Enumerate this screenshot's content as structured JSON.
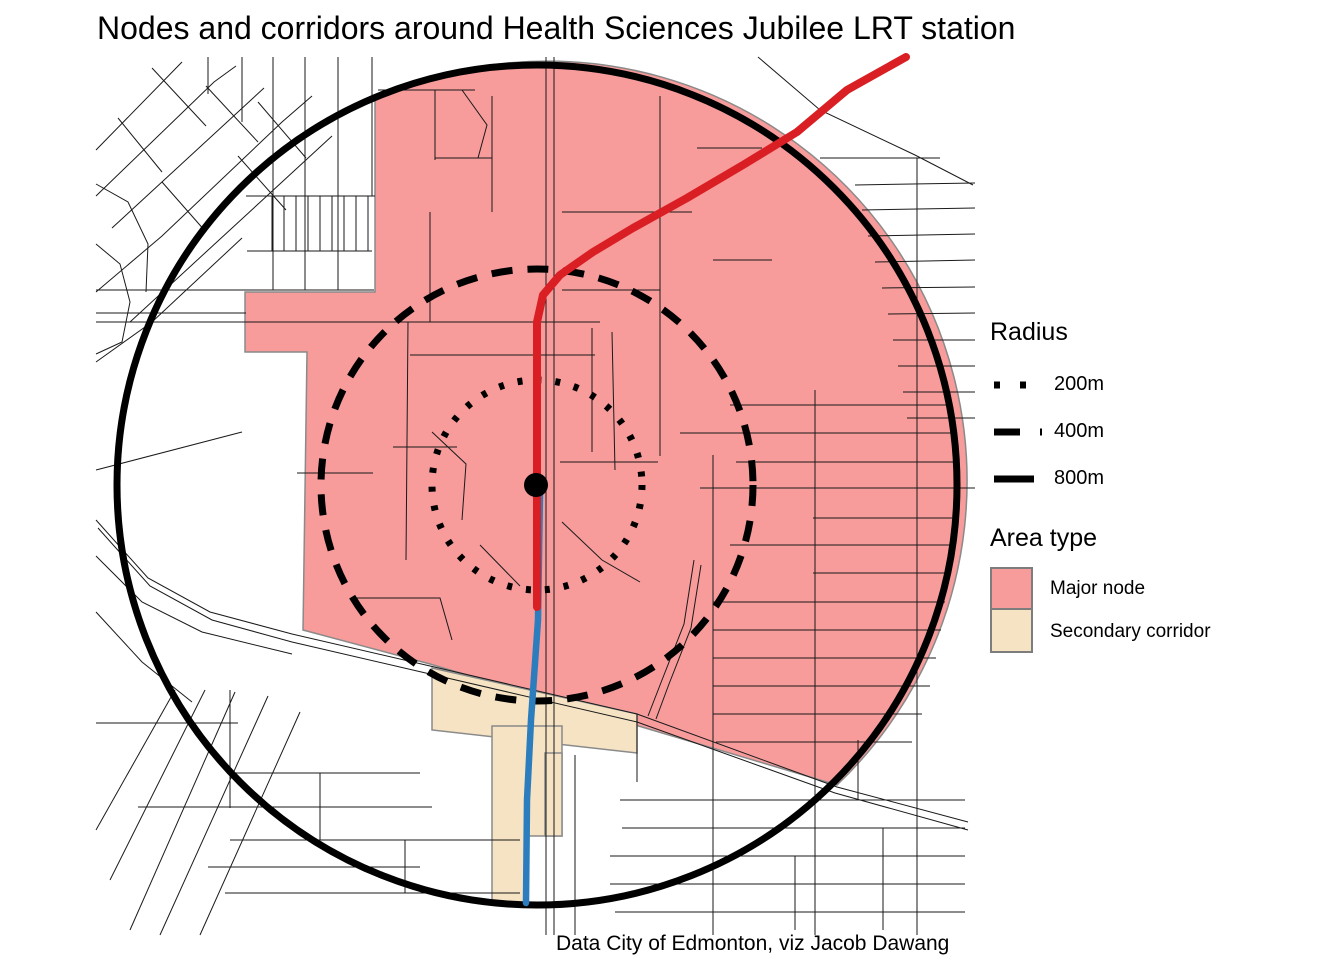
{
  "title": "Nodes and corridors around Health Sciences Jubilee LRT station",
  "caption": "Data City of Edmonton, viz Jacob Dawang",
  "legend": {
    "radius": {
      "title": "Radius",
      "items": [
        {
          "label": "200m",
          "style": "dotted"
        },
        {
          "label": "400m",
          "style": "dashed"
        },
        {
          "label": "800m",
          "style": "solid"
        }
      ]
    },
    "area_type": {
      "title": "Area type",
      "items": [
        {
          "label": "Major node",
          "color_key": "major_node"
        },
        {
          "label": "Secondary corridor",
          "color_key": "secondary_corridor"
        }
      ]
    }
  },
  "colors": {
    "major_node": "#F79B9B",
    "secondary_corridor": "#F5E3C3",
    "area_outline": "#8A8A8A",
    "lrt_line_northeast": "#D91F24",
    "lrt_line_south": "#2B7DBD",
    "street": "#1A1A1A",
    "ring": "#000000",
    "station": "#000000"
  },
  "map": {
    "center": {
      "x": 537,
      "y": 485
    },
    "station_point": {
      "x": 536,
      "y": 485,
      "radius_px": 12
    },
    "rings": [
      {
        "label": "200m",
        "meters": 200,
        "r_px": 105,
        "style": "dotted"
      },
      {
        "label": "400m",
        "meters": 400,
        "r_px": 216,
        "style": "dashed"
      },
      {
        "label": "800m",
        "meters": 800,
        "r_px": 420,
        "style": "solid"
      }
    ],
    "major_node_path": "M375 98 A420 420 0 0 1 837 785 L430 664 L303 630 L307 352 L245 352 L245 292 L375 292 Z",
    "secondary_polygons": [
      [
        [
          432,
          668
        ],
        [
          637,
          714
        ],
        [
          637,
          753
        ],
        [
          432,
          730
        ]
      ],
      [
        [
          492,
          726
        ],
        [
          562,
          726
        ],
        [
          562,
          836
        ],
        [
          528,
          836
        ],
        [
          528,
          903
        ],
        [
          492,
          903
        ]
      ],
      [
        [
          545,
          753
        ],
        [
          562,
          753
        ],
        [
          562,
          836
        ],
        [
          545,
          836
        ]
      ]
    ],
    "lrt_red": [
      [
        906,
        57
      ],
      [
        847,
        90
      ],
      [
        797,
        132
      ],
      [
        743,
        165
      ],
      [
        687,
        198
      ],
      [
        633,
        228
      ],
      [
        593,
        252
      ],
      [
        560,
        275
      ],
      [
        543,
        295
      ],
      [
        537,
        322
      ],
      [
        537,
        607
      ]
    ],
    "lrt_blue": [
      [
        540,
        492
      ],
      [
        538,
        620
      ],
      [
        531,
        720
      ],
      [
        527,
        800
      ],
      [
        526,
        903
      ]
    ],
    "streets": [
      [
        [
          96,
          520
        ],
        [
          148,
          578
        ],
        [
          210,
          612
        ],
        [
          292,
          634
        ],
        [
          430,
          666
        ],
        [
          637,
          714
        ],
        [
          837,
          787
        ],
        [
          968,
          822
        ]
      ],
      [
        [
          98,
          528
        ],
        [
          150,
          586
        ],
        [
          212,
          620
        ],
        [
          292,
          642
        ],
        [
          430,
          674
        ],
        [
          637,
          722
        ],
        [
          835,
          793
        ],
        [
          968,
          830
        ]
      ],
      [
        [
          546,
          57
        ],
        [
          546,
          935
        ]
      ],
      [
        [
          554,
          57
        ],
        [
          554,
          935
        ]
      ],
      [
        [
          96,
          150
        ],
        [
          182,
          62
        ]
      ],
      [
        [
          96,
          196
        ],
        [
          214,
          82
        ],
        [
          236,
          66
        ]
      ],
      [
        [
          112,
          228
        ],
        [
          264,
          88
        ]
      ],
      [
        [
          96,
          292
        ],
        [
          162,
          236
        ],
        [
          282,
          122
        ],
        [
          312,
          96
        ]
      ],
      [
        [
          130,
          322
        ],
        [
          206,
          252
        ],
        [
          332,
          136
        ]
      ],
      [
        [
          96,
          362
        ],
        [
          152,
          322
        ],
        [
          242,
          238
        ]
      ],
      [
        [
          152,
          68
        ],
        [
          206,
          126
        ]
      ],
      [
        [
          206,
          86
        ],
        [
          258,
          142
        ]
      ],
      [
        [
          258,
          102
        ],
        [
          306,
          158
        ]
      ],
      [
        [
          162,
          182
        ],
        [
          206,
          232
        ]
      ],
      [
        [
          238,
          156
        ],
        [
          286,
          210
        ]
      ],
      [
        [
          118,
          118
        ],
        [
          162,
          172
        ]
      ],
      [
        [
          96,
          184
        ],
        [
          128,
          202
        ],
        [
          148,
          244
        ],
        [
          146,
          292
        ]
      ],
      [
        [
          96,
          244
        ],
        [
          120,
          264
        ],
        [
          130,
          302
        ],
        [
          122,
          342
        ],
        [
          96,
          354
        ]
      ],
      [
        [
          208,
          57
        ],
        [
          208,
          94
        ]
      ],
      [
        [
          242,
          57
        ],
        [
          242,
          122
        ]
      ],
      [
        [
          273,
          57
        ],
        [
          273,
          290
        ]
      ],
      [
        [
          305,
          57
        ],
        [
          305,
          290
        ]
      ],
      [
        [
          338,
          57
        ],
        [
          338,
          290
        ]
      ],
      [
        [
          372,
          57
        ],
        [
          372,
          196
        ]
      ],
      [
        [
          246,
          196
        ],
        [
          375,
          196
        ]
      ],
      [
        [
          272,
          196
        ],
        [
          272,
          251
        ]
      ],
      [
        [
          284,
          196
        ],
        [
          284,
          251
        ]
      ],
      [
        [
          296,
          196
        ],
        [
          296,
          251
        ]
      ],
      [
        [
          308,
          196
        ],
        [
          308,
          251
        ]
      ],
      [
        [
          320,
          196
        ],
        [
          320,
          251
        ]
      ],
      [
        [
          332,
          196
        ],
        [
          332,
          251
        ]
      ],
      [
        [
          344,
          196
        ],
        [
          344,
          251
        ]
      ],
      [
        [
          356,
          196
        ],
        [
          356,
          251
        ]
      ],
      [
        [
          368,
          196
        ],
        [
          368,
          251
        ]
      ],
      [
        [
          247,
          251
        ],
        [
          372,
          251
        ]
      ],
      [
        [
          96,
          290
        ],
        [
          374,
          290
        ]
      ],
      [
        [
          96,
          313
        ],
        [
          246,
          313
        ]
      ],
      [
        [
          96,
          322
        ],
        [
          600,
          322
        ]
      ],
      [
        [
          96,
          470
        ],
        [
          242,
          432
        ]
      ],
      [
        [
          96,
          556
        ],
        [
          142,
          602
        ],
        [
          202,
          632
        ],
        [
          292,
          654
        ]
      ],
      [
        [
          96,
          612
        ],
        [
          142,
          662
        ],
        [
          192,
          702
        ]
      ],
      [
        [
          175,
          690
        ],
        [
          96,
          830
        ]
      ],
      [
        [
          205,
          690
        ],
        [
          110,
          880
        ]
      ],
      [
        [
          235,
          692
        ],
        [
          130,
          930
        ]
      ],
      [
        [
          268,
          696
        ],
        [
          160,
          935
        ]
      ],
      [
        [
          300,
          712
        ],
        [
          200,
          935
        ]
      ],
      [
        [
          230,
          690
        ],
        [
          230,
          808
        ]
      ],
      [
        [
          96,
          723
        ],
        [
          238,
          723
        ]
      ],
      [
        [
          230,
          773
        ],
        [
          420,
          773
        ]
      ],
      [
        [
          138,
          807
        ],
        [
          432,
          807
        ]
      ],
      [
        [
          230,
          840
        ],
        [
          520,
          840
        ]
      ],
      [
        [
          208,
          867
        ],
        [
          420,
          867
        ]
      ],
      [
        [
          225,
          893
        ],
        [
          520,
          893
        ]
      ],
      [
        [
          320,
          773
        ],
        [
          320,
          840
        ]
      ],
      [
        [
          405,
          840
        ],
        [
          405,
          893
        ]
      ],
      [
        [
          408,
          322
        ],
        [
          406,
          560
        ]
      ],
      [
        [
          410,
          355
        ],
        [
          595,
          355
        ]
      ],
      [
        [
          592,
          328
        ],
        [
          592,
          452
        ]
      ],
      [
        [
          393,
          447
        ],
        [
          457,
          447
        ]
      ],
      [
        [
          297,
          473
        ],
        [
          373,
          473
        ]
      ],
      [
        [
          430,
          212
        ],
        [
          430,
          322
        ]
      ],
      [
        [
          352,
          598
        ],
        [
          440,
          598
        ],
        [
          452,
          640
        ]
      ],
      [
        [
          432,
          432
        ],
        [
          466,
          464
        ],
        [
          462,
          520
        ]
      ],
      [
        [
          480,
          545
        ],
        [
          520,
          586
        ]
      ],
      [
        [
          560,
          462
        ],
        [
          658,
          462
        ]
      ],
      [
        [
          612,
          332
        ],
        [
          615,
          470
        ]
      ],
      [
        [
          562,
          522
        ],
        [
          602,
          560
        ],
        [
          640,
          582
        ]
      ],
      [
        [
          694,
          560
        ],
        [
          684,
          624
        ],
        [
          662,
          680
        ],
        [
          648,
          716
        ]
      ],
      [
        [
          701,
          565
        ],
        [
          691,
          628
        ],
        [
          669,
          684
        ],
        [
          656,
          719
        ]
      ],
      [
        [
          378,
          90
        ],
        [
          475,
          90
        ]
      ],
      [
        [
          435,
          90
        ],
        [
          435,
          160
        ]
      ],
      [
        [
          462,
          90
        ],
        [
          487,
          125
        ],
        [
          478,
          158
        ]
      ],
      [
        [
          492,
          96
        ],
        [
          492,
          212
        ]
      ],
      [
        [
          435,
          158
        ],
        [
          492,
          158
        ]
      ],
      [
        [
          562,
          212
        ],
        [
          692,
          212
        ]
      ],
      [
        [
          660,
          96
        ],
        [
          660,
          456
        ]
      ],
      [
        [
          562,
          290
        ],
        [
          660,
          290
        ]
      ],
      [
        [
          697,
          148
        ],
        [
          762,
          148
        ]
      ],
      [
        [
          713,
          260
        ],
        [
          772,
          260
        ]
      ],
      [
        [
          758,
          57
        ],
        [
          820,
          110
        ],
        [
          915,
          155
        ],
        [
          973,
          185
        ]
      ],
      [
        [
          820,
          158
        ],
        [
          940,
          158
        ]
      ],
      [
        [
          855,
          185
        ],
        [
          975,
          183
        ]
      ],
      [
        [
          862,
          210
        ],
        [
          975,
          208
        ]
      ],
      [
        [
          868,
          236
        ],
        [
          975,
          234
        ]
      ],
      [
        [
          875,
          262
        ],
        [
          975,
          260
        ]
      ],
      [
        [
          882,
          288
        ],
        [
          975,
          287
        ]
      ],
      [
        [
          888,
          314
        ],
        [
          975,
          313
        ]
      ],
      [
        [
          893,
          340
        ],
        [
          975,
          340
        ]
      ],
      [
        [
          898,
          366
        ],
        [
          975,
          366
        ]
      ],
      [
        [
          903,
          392
        ],
        [
          975,
          392
        ]
      ],
      [
        [
          907,
          418
        ],
        [
          975,
          418
        ]
      ],
      [
        [
          917,
          158
        ],
        [
          917,
          935
        ]
      ],
      [
        [
          730,
          405
        ],
        [
          949,
          405
        ]
      ],
      [
        [
          680,
          433
        ],
        [
          951,
          433
        ]
      ],
      [
        [
          736,
          462
        ],
        [
          953,
          462
        ]
      ],
      [
        [
          700,
          488
        ],
        [
          975,
          488
        ]
      ],
      [
        [
          813,
          518
        ],
        [
          952,
          518
        ]
      ],
      [
        [
          730,
          545
        ],
        [
          950,
          545
        ]
      ],
      [
        [
          813,
          573
        ],
        [
          948,
          573
        ]
      ],
      [
        [
          713,
          602
        ],
        [
          945,
          602
        ]
      ],
      [
        [
          713,
          630
        ],
        [
          941,
          630
        ]
      ],
      [
        [
          713,
          658
        ],
        [
          936,
          658
        ]
      ],
      [
        [
          713,
          686
        ],
        [
          930,
          686
        ]
      ],
      [
        [
          713,
          714
        ],
        [
          922,
          714
        ]
      ],
      [
        [
          716,
          742
        ],
        [
          912,
          742
        ]
      ],
      [
        [
          713,
          455
        ],
        [
          713,
          935
        ]
      ],
      [
        [
          815,
          390
        ],
        [
          815,
          935
        ]
      ],
      [
        [
          858,
          740
        ],
        [
          858,
          800
        ]
      ],
      [
        [
          883,
          828
        ],
        [
          883,
          930
        ]
      ],
      [
        [
          795,
          856
        ],
        [
          795,
          930
        ]
      ],
      [
        [
          620,
          800
        ],
        [
          965,
          800
        ]
      ],
      [
        [
          622,
          828
        ],
        [
          965,
          828
        ]
      ],
      [
        [
          610,
          856
        ],
        [
          965,
          856
        ]
      ],
      [
        [
          610,
          884
        ],
        [
          965,
          884
        ]
      ],
      [
        [
          615,
          912
        ],
        [
          965,
          912
        ]
      ],
      [
        [
          575,
          755
        ],
        [
          575,
          935
        ]
      ],
      [
        [
          637,
          714
        ],
        [
          637,
          782
        ]
      ]
    ]
  }
}
